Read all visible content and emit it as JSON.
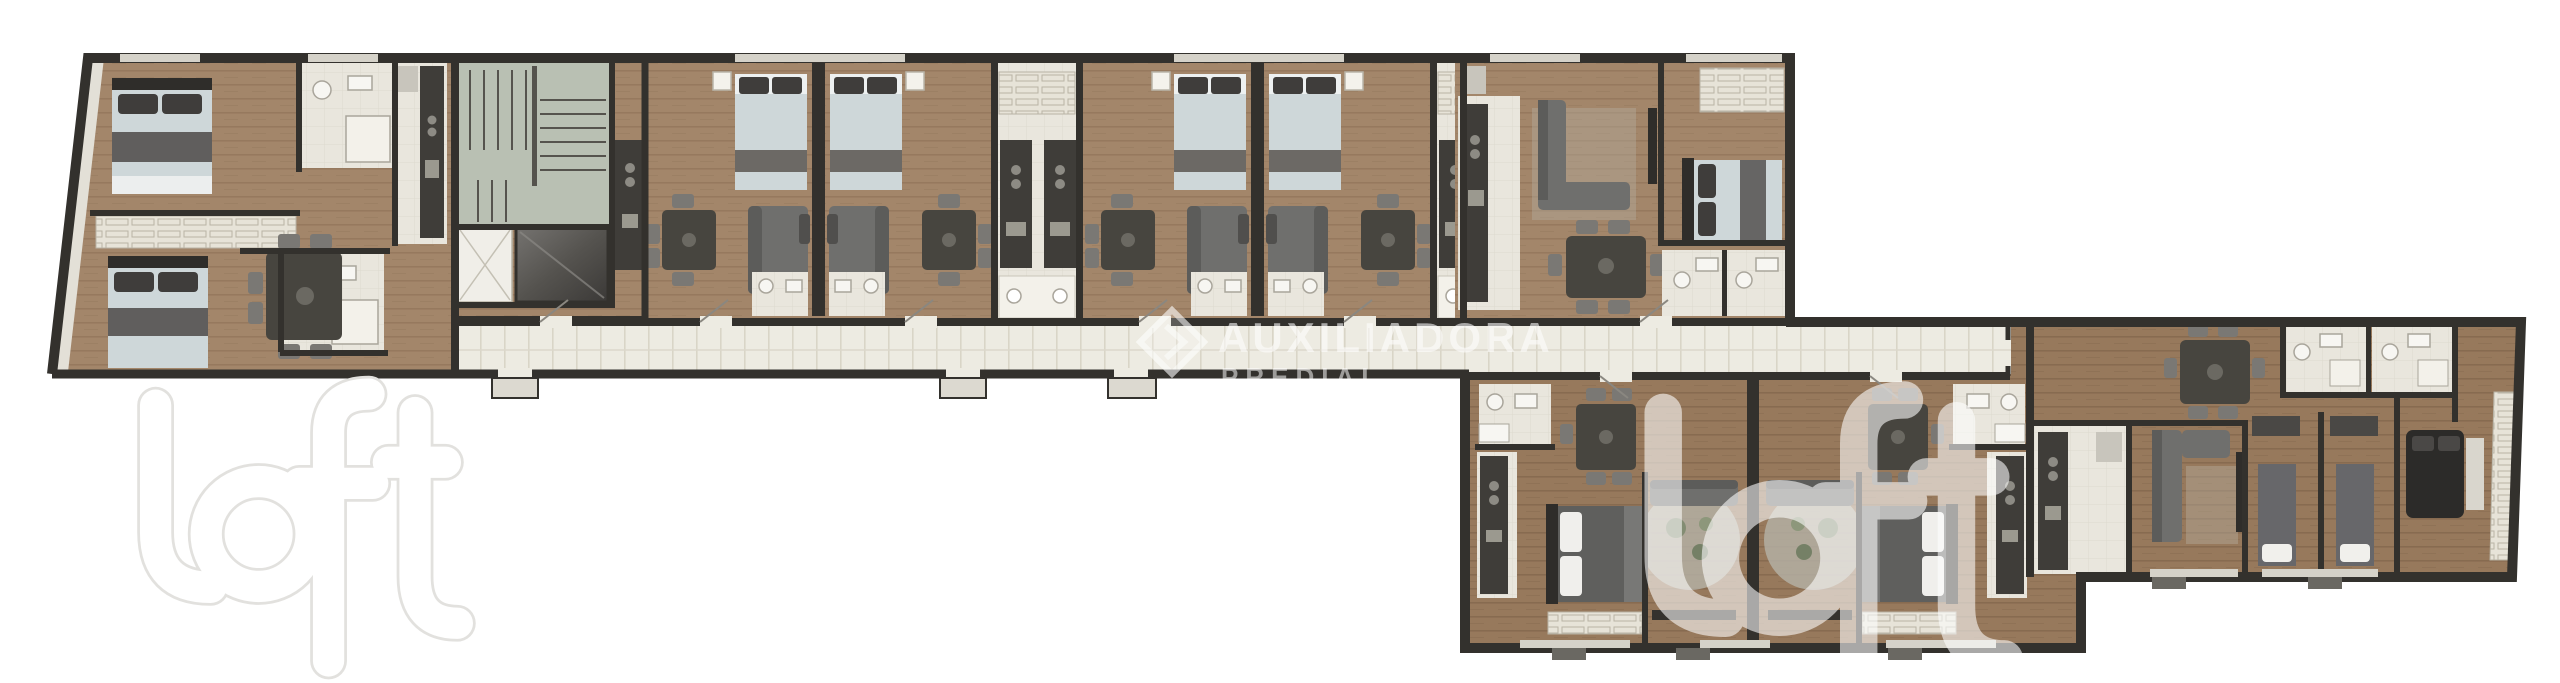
{
  "watermarks": {
    "agency": {
      "icon": "diamond-chevron-icon",
      "line1": "AUXILIADORA",
      "line2": "PREDIAL",
      "color": "#ffffff"
    },
    "brand_primary": "loft",
    "brand_secondary": "loft"
  },
  "palette": {
    "background": "#ffffff",
    "walls": "#33312d",
    "wood_floor": "#a3866a",
    "corridor_floor": "#edebe2",
    "tile_floor": "#e9e6dd",
    "stairwell": "#b9c0b3",
    "elevator_dark": "#4a4845",
    "bed_linen": "#ced7d9",
    "dark_pillow": "#3f3d3b",
    "sofa": "#6f6f6d",
    "dark_furniture": "#47453f",
    "closet": "#e7e3d8",
    "watermark_white": "#ffffff"
  },
  "legend": {
    "features": [
      "bedroom-bed-icon",
      "bathroom-icon",
      "kitchen-counter-icon",
      "dining-table-icon",
      "sofa-icon",
      "stairwell-icon",
      "elevator-icon",
      "corridor",
      "balcony-stoop",
      "wardrobe-icon",
      "rug-icon"
    ]
  }
}
